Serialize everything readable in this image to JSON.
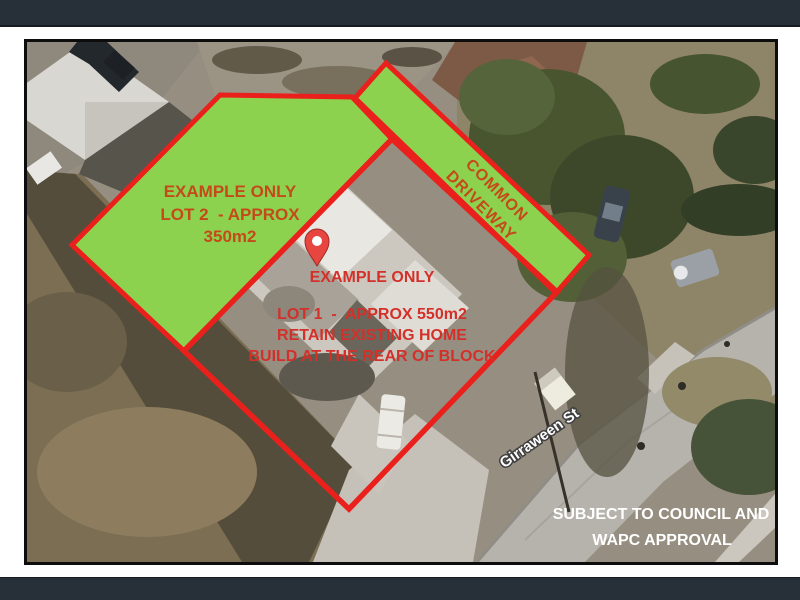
{
  "frame": {
    "top_bar_color": "#272f38",
    "bottom_bar_color": "#272f38",
    "photo_border_color": "#0d0d0d"
  },
  "map": {
    "street_label": "Girraween St"
  },
  "overlay": {
    "boundary_color": "#ea201c",
    "lot_fill_color": "#8dd24f",
    "pin_color": "#e64540",
    "lot2": {
      "line1": "EXAMPLE ONLY",
      "line2": "LOT 2  - APPROX",
      "line3": "350m2",
      "text_color": "#c44a1a"
    },
    "lot1": {
      "line1": "EXAMPLE ONLY",
      "line2": "LOT 1  -  APPROX 550m2",
      "line3": "RETAIN EXISTING HOME",
      "line4": "BUILD AT THE REAR OF BLOCK",
      "text_color": "#d4302a"
    },
    "driveway": {
      "line1": "COMMON",
      "line2": "DRIVEWAY",
      "text_color": "#c44a1a"
    },
    "approval": {
      "line1": "SUBJECT TO COUNCIL AND",
      "line2": "WAPC APPROVAL",
      "text_color": "#ffffff"
    }
  }
}
